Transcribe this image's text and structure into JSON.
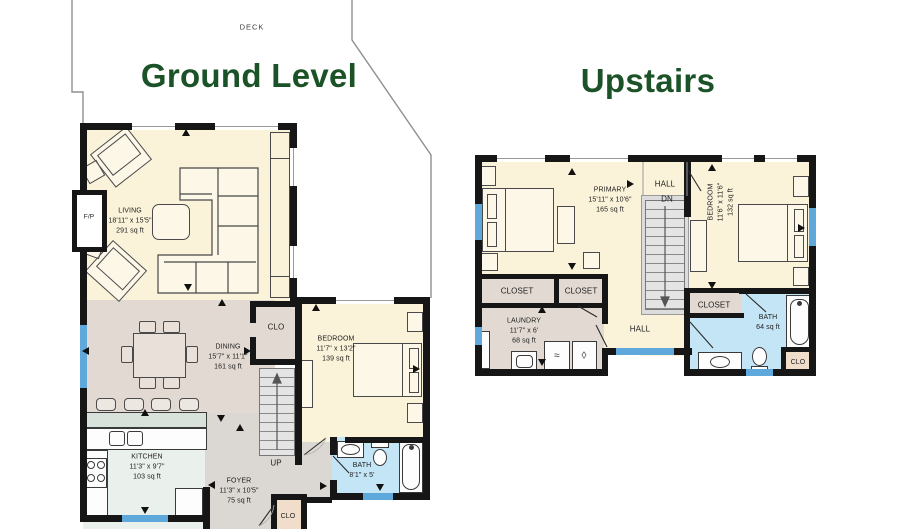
{
  "deck_label": "DECK",
  "levels": {
    "ground": {
      "title": "Ground Level",
      "rooms": {
        "living": {
          "name": "LIVING",
          "dims": "18'11\" x 15'5\"",
          "area": "291 sq ft"
        },
        "dining": {
          "name": "DINING",
          "dims": "15'7\" x 11'1\"",
          "area": "161 sq ft"
        },
        "kitchen": {
          "name": "KITCHEN",
          "dims": "11'3\" x 9'7\"",
          "area": "103 sq ft"
        },
        "foyer": {
          "name": "FOYER",
          "dims": "11'3\" x 10'5\"",
          "area": "75 sq ft"
        },
        "bedroom": {
          "name": "BEDROOM",
          "dims": "11'7\" x 13'2\"",
          "area": "139 sq ft"
        },
        "bath": {
          "name": "BATH",
          "dims": "8'1\" x 5'"
        }
      },
      "labels": {
        "closet_upper": "CLO",
        "closet_entry": "CLO",
        "fireplace": "F/P",
        "stairs_up": "UP"
      }
    },
    "upstairs": {
      "title": "Upstairs",
      "rooms": {
        "primary": {
          "name": "PRIMARY",
          "dims": "15'11\" x 10'6\"",
          "area": "165 sq ft"
        },
        "bedroom": {
          "name": "BEDROOM",
          "dims": "11'6\" x 11'6\"",
          "area": "132 sq ft"
        },
        "laundry": {
          "name": "LAUNDRY",
          "dims": "11'7\" x 6'",
          "area": "68 sq ft"
        },
        "bath": {
          "name": "BATH",
          "area": "64 sq ft"
        }
      },
      "labels": {
        "hall_upper": "HALL",
        "stairs_down": "DN",
        "hall_lower": "HALL",
        "closet_primary_1": "CLOSET",
        "closet_primary_2": "CLOSET",
        "closet_bedroom": "CLOSET",
        "closet_bath": "CLO"
      }
    }
  },
  "colors": {
    "title_green": "#1B5227",
    "wall": "#161616",
    "room_cream": "#FAF3DA",
    "room_taupe": "#E2DAD2",
    "room_gray": "#DBD7D2",
    "room_mint": "#EAF0EB",
    "counter_green": "#D8E2DB",
    "counter_white": "#FAFBFA",
    "bath_blue": "#C4E5F6",
    "window_blue": "#5FA8DC",
    "closet_peach": "#F0DECB"
  }
}
